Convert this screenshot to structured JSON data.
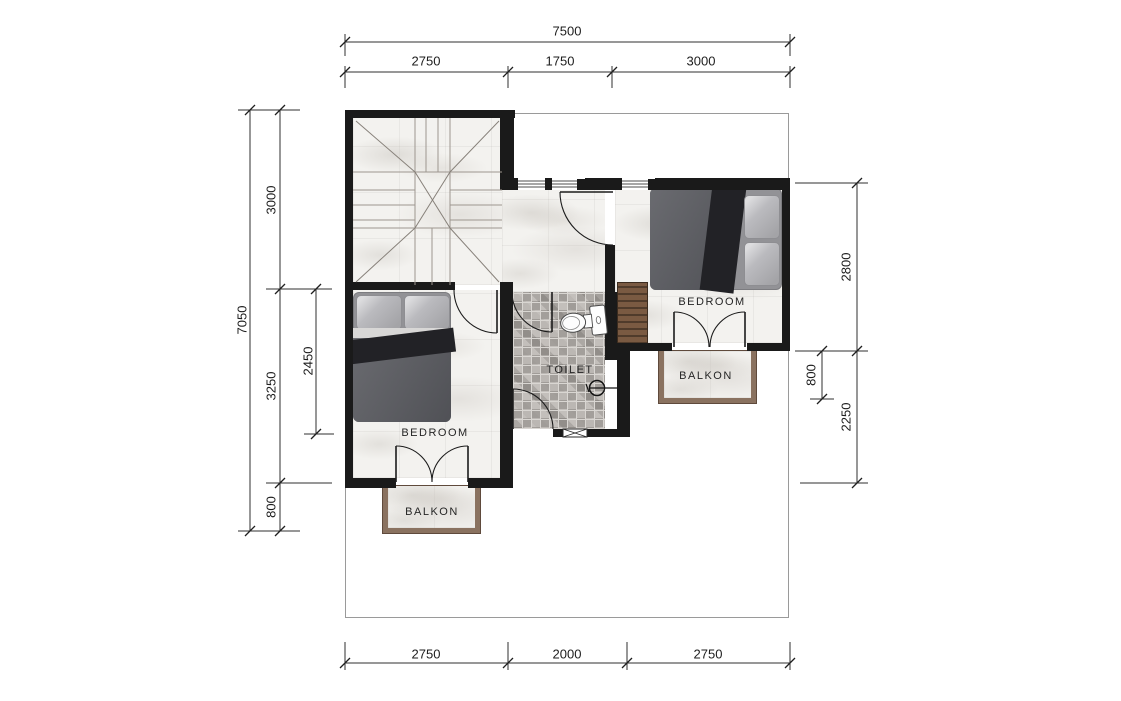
{
  "labels": {
    "bedroom_top_right": "BEDROOM",
    "bedroom_bottom_left": "BEDROOM",
    "toilet": "TOILET",
    "balkon_left": "BALKON",
    "balkon_right": "BALKON"
  },
  "dimensions": {
    "top": {
      "total": "7500",
      "segments": [
        "2750",
        "1750",
        "3000"
      ]
    },
    "bottom": {
      "segments": [
        "2750",
        "2000",
        "2750"
      ]
    },
    "left": {
      "total": "7050",
      "segments": [
        "3000",
        "3250",
        "800"
      ],
      "inner": "2450"
    },
    "right": {
      "segments": [
        "2800",
        "2250"
      ],
      "inner": "800"
    }
  },
  "colors": {
    "wall": "#1a1a1a",
    "wood": "#7a5a42",
    "mosaic_tile": "#aba7a3",
    "marble": "#f3f2ef",
    "balcony_frame": "#8a7260",
    "dimension_line": "#2f2f2f"
  }
}
